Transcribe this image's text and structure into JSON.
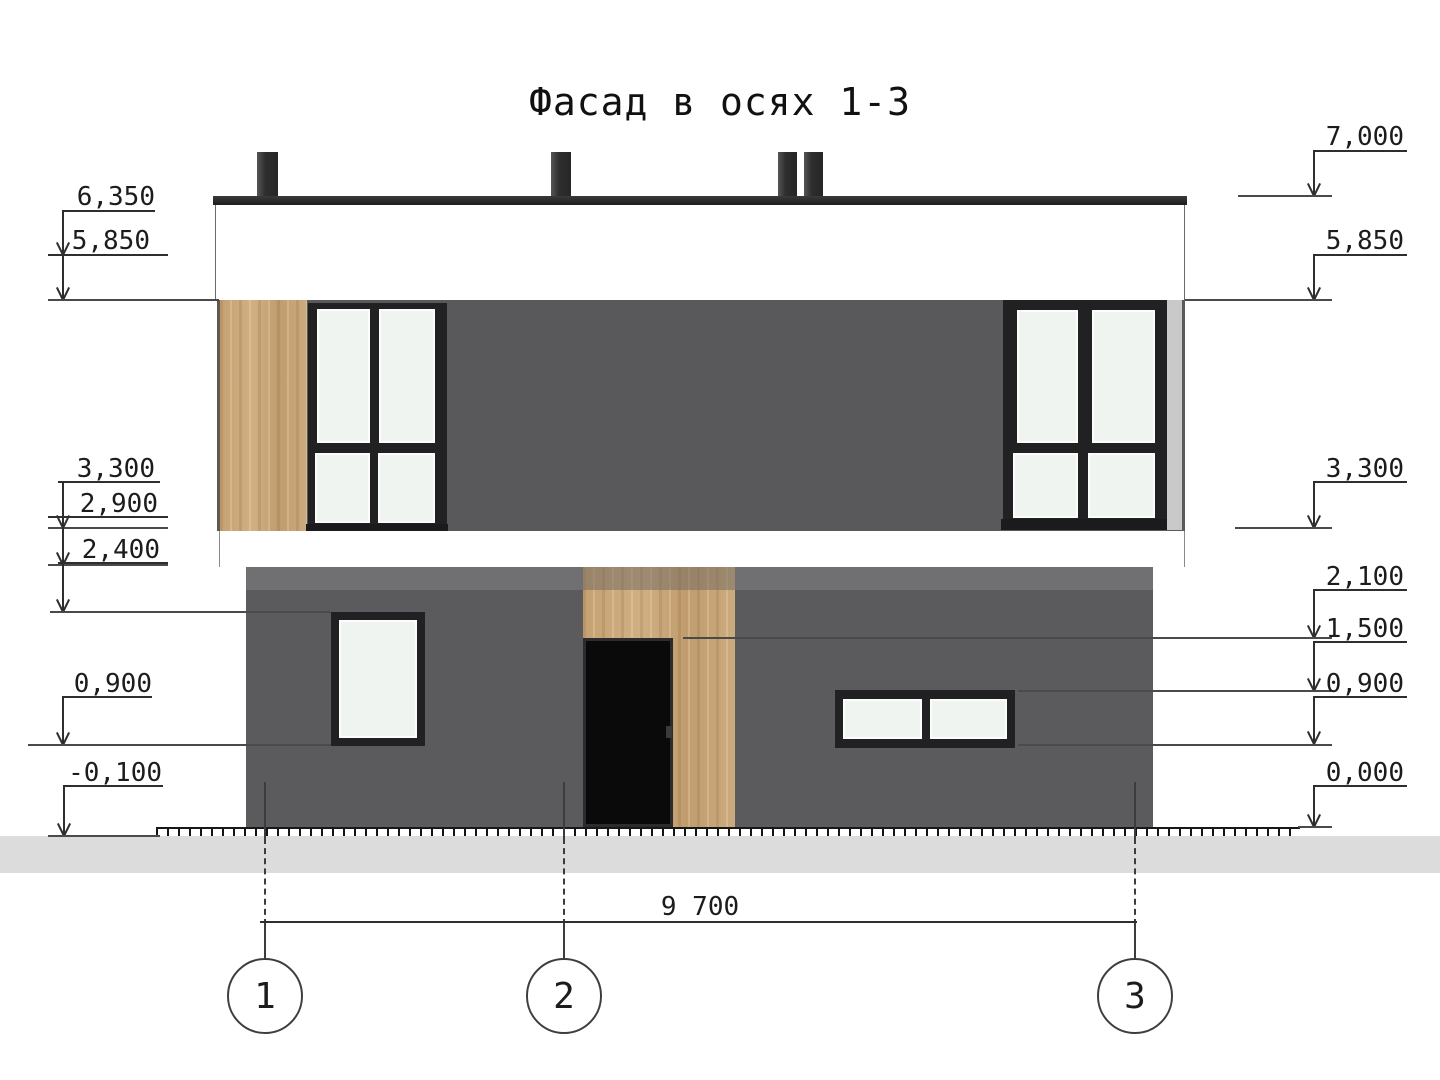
{
  "title": "Фасад в осях 1-3",
  "drawing_type": "facade-elevation",
  "elevations": {
    "left": [
      {
        "label": "6,350"
      },
      {
        "label": "5,850"
      },
      {
        "label": "3,300"
      },
      {
        "label": "2,900"
      },
      {
        "label": "2,400"
      },
      {
        "label": "0,900"
      },
      {
        "label": "-0,100"
      }
    ],
    "right": [
      {
        "label": "7,000"
      },
      {
        "label": "5,850"
      },
      {
        "label": "3,300"
      },
      {
        "label": "2,100"
      },
      {
        "label": "1,500"
      },
      {
        "label": "0,900"
      },
      {
        "label": "0,000"
      }
    ]
  },
  "dimensions": {
    "overall_width": "9 700"
  },
  "axes": [
    {
      "label": "1"
    },
    {
      "label": "2"
    },
    {
      "label": "3"
    }
  ],
  "colors": {
    "wall_upper": "#59595b",
    "wall_lower": "#5b5b5d",
    "wall_lower_band": "#707072",
    "wood": "#c8a478",
    "window_frame": "#212123",
    "glass": "#f0f4f0",
    "roof": "#2e2e2e",
    "door": "#0a0a0a",
    "ground": "#dcdcdc",
    "corner_strip": "#c9c9c9",
    "line": "#2e2e2e"
  }
}
